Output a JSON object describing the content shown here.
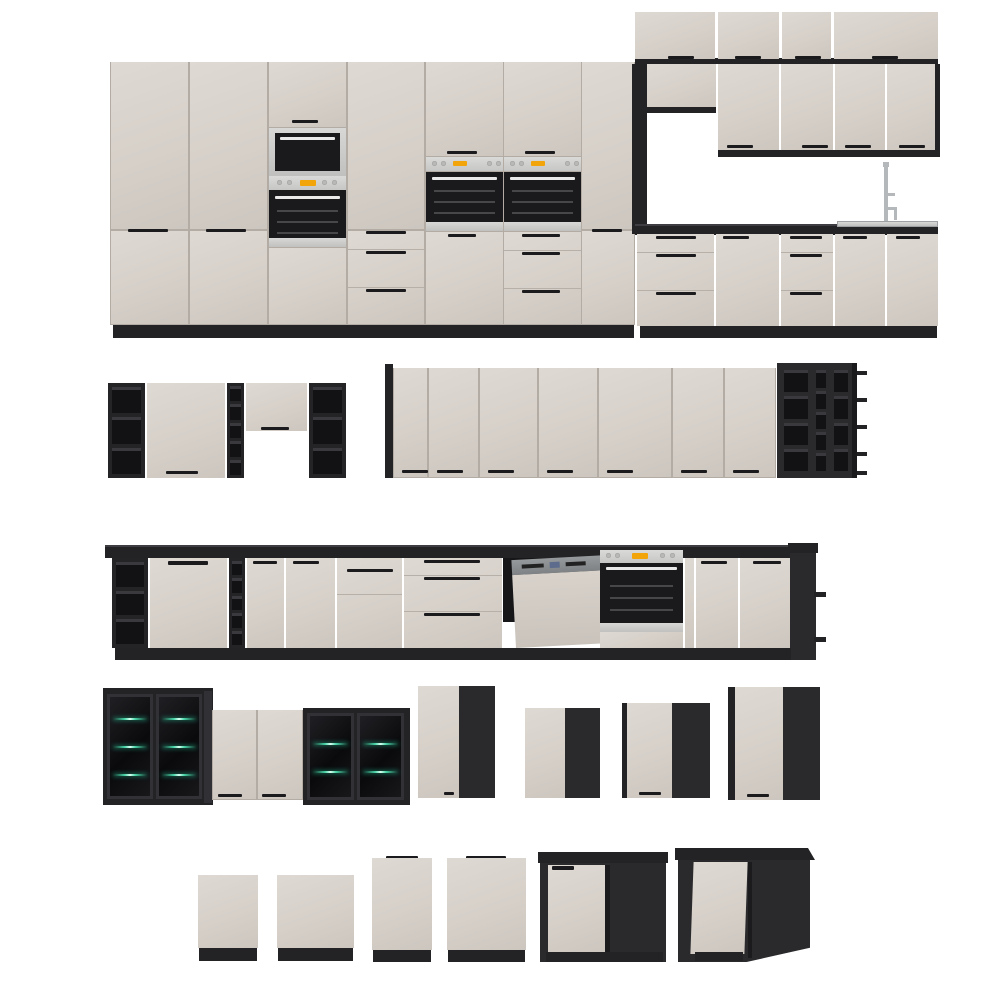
{
  "meta": {
    "description": "Product render sheet: modular kitchen furniture set with cream gloss fronts and black carcasses / open shelving, shown as five rows of 3D renders on white"
  },
  "palette": {
    "background": "#ffffff",
    "front_cream": "#d6d0c9",
    "carcass_black": "#232326",
    "carcass_black_light": "#2a2a2d",
    "gap_line": "#b2aca5",
    "handle_black": "#1b1b1e",
    "stainless": "#c8c8c6",
    "oven_glass": "#1a1a1d",
    "display_amber": "#f2a40b",
    "dishwasher_steel": "#8a8e90",
    "glass_shelf_green": "#49d6a8"
  },
  "rows": [
    {
      "name": "full-kitchen-front-view",
      "items": [
        "tall-cabinet-run",
        "built-in-microwave-oven-column",
        "two-built-in-oven-columns",
        "corner-wall-cabinets",
        "sink-base-run-with-faucet",
        "drawer-base-units"
      ]
    },
    {
      "name": "wall-cabinet-run-angled",
      "items": [
        "open-shelf-end-unit",
        "wall-door-cabinet",
        "narrow-open-shelf-column",
        "bridge-cabinet",
        "open-shelf-unit",
        "seven-door-wall-run",
        "open-shelf-grid-end-unit"
      ]
    },
    {
      "name": "base-cabinet-run-with-appliances",
      "items": [
        "open-shelf-end-unit",
        "base-door-cabinets",
        "narrow-open-shelf-column",
        "pan-drawer-unit",
        "three-drawer-unit",
        "semi-integrated-dishwasher-open",
        "built-in-oven",
        "base-door-cabinets",
        "open-shelf-end-unit"
      ]
    },
    {
      "name": "individual-wall-cabinets",
      "items": [
        "black-glass-display-cabinet-3-shelves",
        "cream-two-door-wall-cabinet",
        "black-glass-display-cabinet-2-shelves",
        "corner-wall-cabinet-tall",
        "corner-wall-cabinet-small",
        "corner-wall-cabinet-medium",
        "corner-wall-cabinet-large"
      ]
    },
    {
      "name": "individual-base-fronts-and-corner-bases",
      "items": [
        "appliance-front-panel-small",
        "appliance-front-panel-wide",
        "dishwasher-front-panel-with-handle-small",
        "dishwasher-front-panel-with-handle-wide",
        "corner-base-cabinet-black",
        "l-shaped-corner-base-cabinet-black"
      ]
    }
  ]
}
